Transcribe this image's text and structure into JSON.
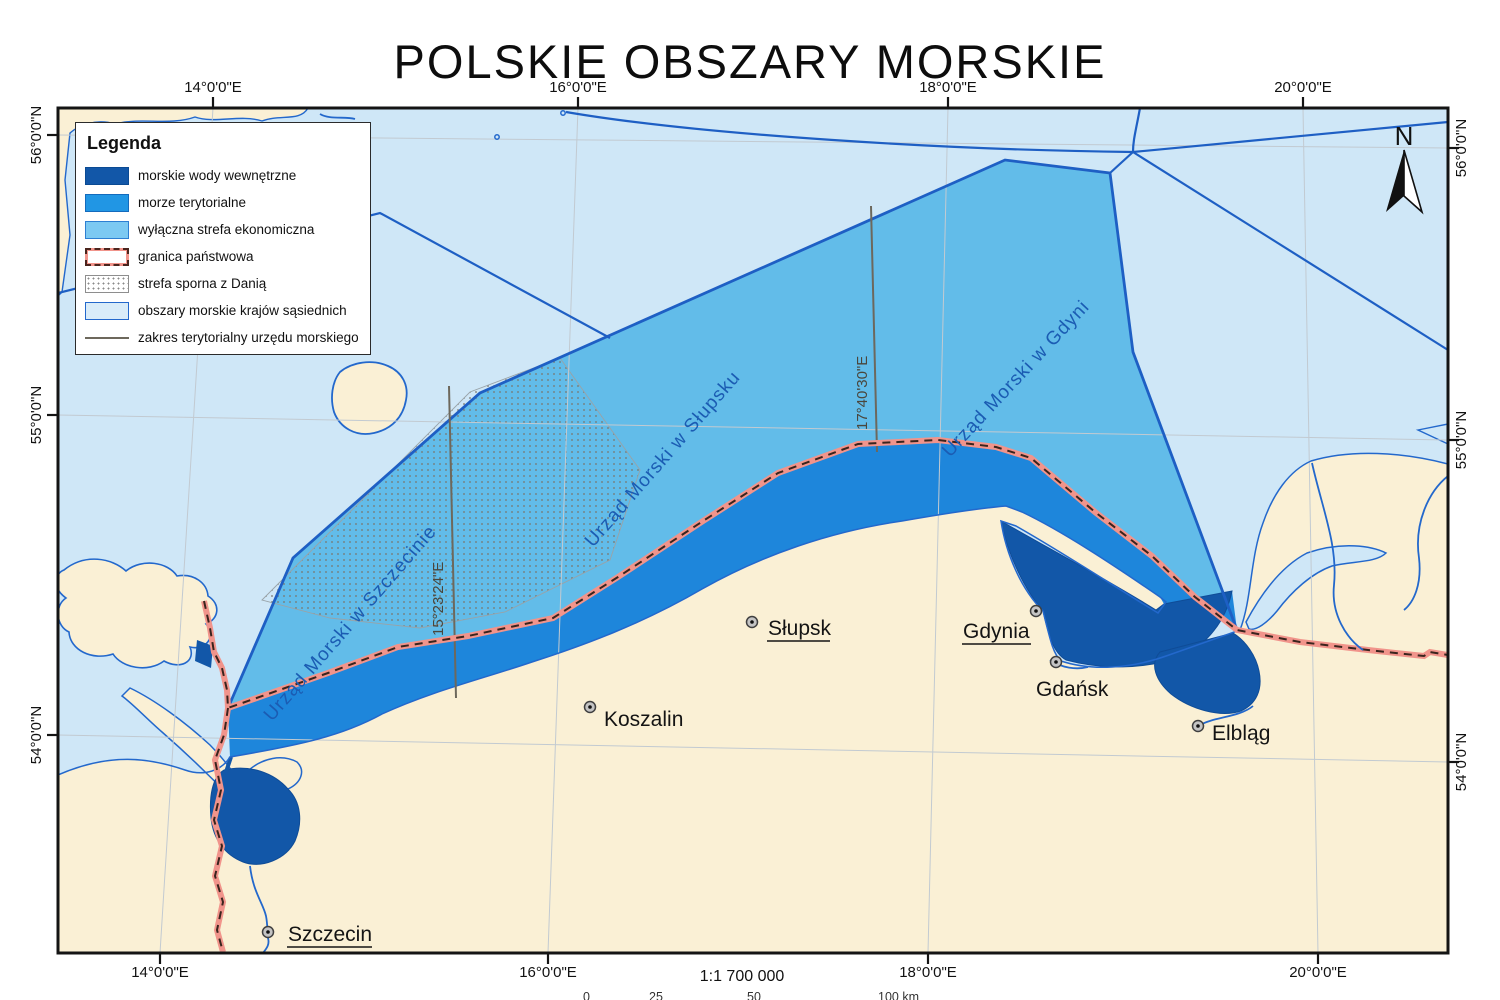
{
  "title": "POLSKIE OBSZARY MORSKIE",
  "legend": {
    "title": "Legenda",
    "items": [
      {
        "label": "morskie wody wewnętrzne",
        "swatch": "internal-waters"
      },
      {
        "label": "morze terytorialne",
        "swatch": "territorial-sea"
      },
      {
        "label": "wyłączna strefa ekonomiczna",
        "swatch": "exclusive-economic-zone"
      },
      {
        "label": "granica państwowa",
        "swatch": "state-border"
      },
      {
        "label": "strefa sporna z Danią",
        "swatch": "disputed-zone-denmark"
      },
      {
        "label": "obszary morskie krajów sąsiednich",
        "swatch": "neighbor-maritime-areas"
      },
      {
        "label": "zakres terytorialny urzędu morskiego",
        "swatch": "maritime-office-extent"
      }
    ]
  },
  "axes": {
    "top": [
      "14°0'0\"E",
      "16°0'0\"E",
      "18°0'0\"E",
      "20°0'0\"E"
    ],
    "bottom": [
      "14°0'0\"E",
      "16°0'0\"E",
      "18°0'0\"E",
      "20°0'0\"E"
    ],
    "left": [
      "56°0'0\"N",
      "55°0'0\"N",
      "54°0'0\"N"
    ],
    "right": [
      "56°0'0\"N",
      "55°0'0\"N",
      "54°0'0\"N"
    ]
  },
  "map": {
    "north": "N",
    "offices": [
      "Urząd Morski w Szczecinie",
      "Urząd Morski w Słupsku",
      "Urząd Morski w Gdyni"
    ],
    "meridians": [
      "15°23'24\"E",
      "17°40'30\"E"
    ],
    "cities": [
      {
        "name": "Szczecin",
        "underlined": true
      },
      {
        "name": "Koszalin",
        "underlined": false
      },
      {
        "name": "Słupsk",
        "underlined": true
      },
      {
        "name": "Gdynia",
        "underlined": true
      },
      {
        "name": "Gdańsk",
        "underlined": false
      },
      {
        "name": "Elbląg",
        "underlined": false
      }
    ]
  },
  "footer": {
    "scale_text": "1:1 700 000",
    "scalebar_labels": [
      "0",
      "25",
      "50",
      "100 km"
    ]
  },
  "colors": {
    "internal_waters": "#1257a8",
    "territorial_sea": "#1e86db",
    "eez": "#62bce9",
    "neighbor_areas": "#cfe7f7",
    "land": "#faf0d5",
    "boundary_blue": "#1e5fc4",
    "coast_blue": "#2368cc",
    "border_band_red": "#f1948b",
    "border_dash": "#3a241e",
    "office_line_gray": "#6d685c"
  }
}
